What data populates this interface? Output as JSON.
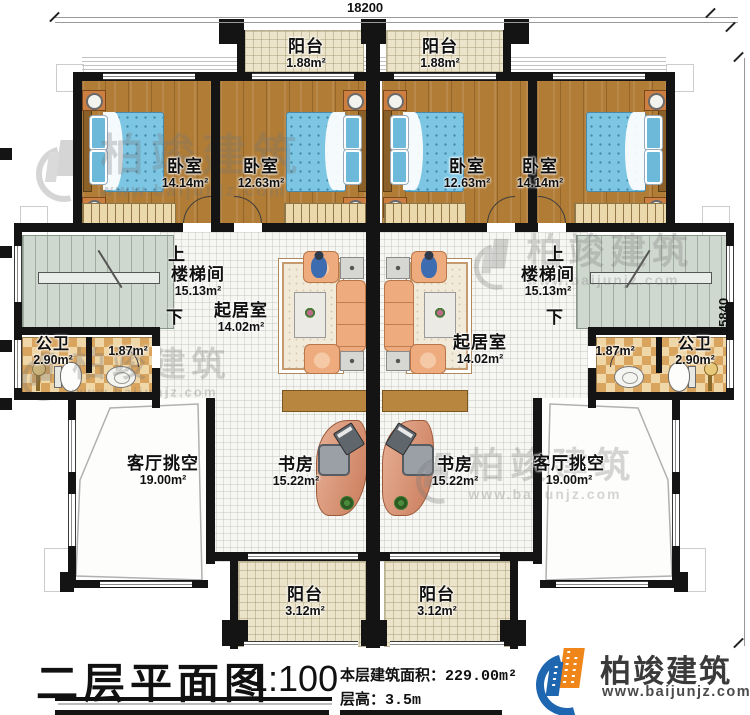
{
  "dimensions": {
    "top": "18200",
    "right": "15840"
  },
  "stair_labels": {
    "up": "上",
    "down": "下"
  },
  "rooms": {
    "balcony_top_left": {
      "name": "阳台",
      "area": "1.88m²"
    },
    "balcony_top_right": {
      "name": "阳台",
      "area": "1.88m²"
    },
    "bedroom_1": {
      "name": "卧室",
      "area": "14.14m²"
    },
    "bedroom_2": {
      "name": "卧室",
      "area": "12.63m²"
    },
    "bedroom_3": {
      "name": "卧室",
      "area": "12.63m²"
    },
    "bedroom_4": {
      "name": "卧室",
      "area": "14.14m²"
    },
    "stairwell_left": {
      "name": "楼梯间",
      "area": "15.13m²"
    },
    "stairwell_right": {
      "name": "楼梯间",
      "area": "15.13m²"
    },
    "living_left": {
      "name": "起居室",
      "area": "14.02m²"
    },
    "living_right": {
      "name": "起居室",
      "area": "14.02m²"
    },
    "bath_left": {
      "name": "公卫",
      "area": "2.90m²"
    },
    "bath_left_inner": {
      "area": "1.87m²"
    },
    "bath_right": {
      "name": "公卫",
      "area": "2.90m²"
    },
    "bath_right_inner": {
      "area": "1.87m²"
    },
    "void_left": {
      "name": "客厅挑空",
      "area": "19.00m²"
    },
    "void_right": {
      "name": "客厅挑空",
      "area": "19.00m²"
    },
    "study_left": {
      "name": "书房",
      "area": "15.22m²"
    },
    "study_right": {
      "name": "书房",
      "area": "15.22m²"
    },
    "balcony_bottom_left": {
      "name": "阳台",
      "area": "3.12m²"
    },
    "balcony_bottom_right": {
      "name": "阳台",
      "area": "3.12m²"
    }
  },
  "footer": {
    "title": "二层平面图",
    "scale": "1:100",
    "area_label": "本层建筑面积：",
    "area_value": "229.00m²",
    "height_label": "层高：",
    "height_value": "3.5m"
  },
  "brand": {
    "name": "柏竣建筑",
    "website": "www.baijunjz.com"
  },
  "watermark": {
    "name": "柏竣建筑",
    "website": "www.baijunjz.com"
  },
  "colors": {
    "wall": "#141414",
    "wood_floor": "#b07c36",
    "stair_floor": "#cfd8cf",
    "bath_checker": "#d9a55e",
    "balcony_floor": "#ece4ca",
    "brand_blue": "#1f66b0",
    "brand_orange": "#f08519"
  }
}
